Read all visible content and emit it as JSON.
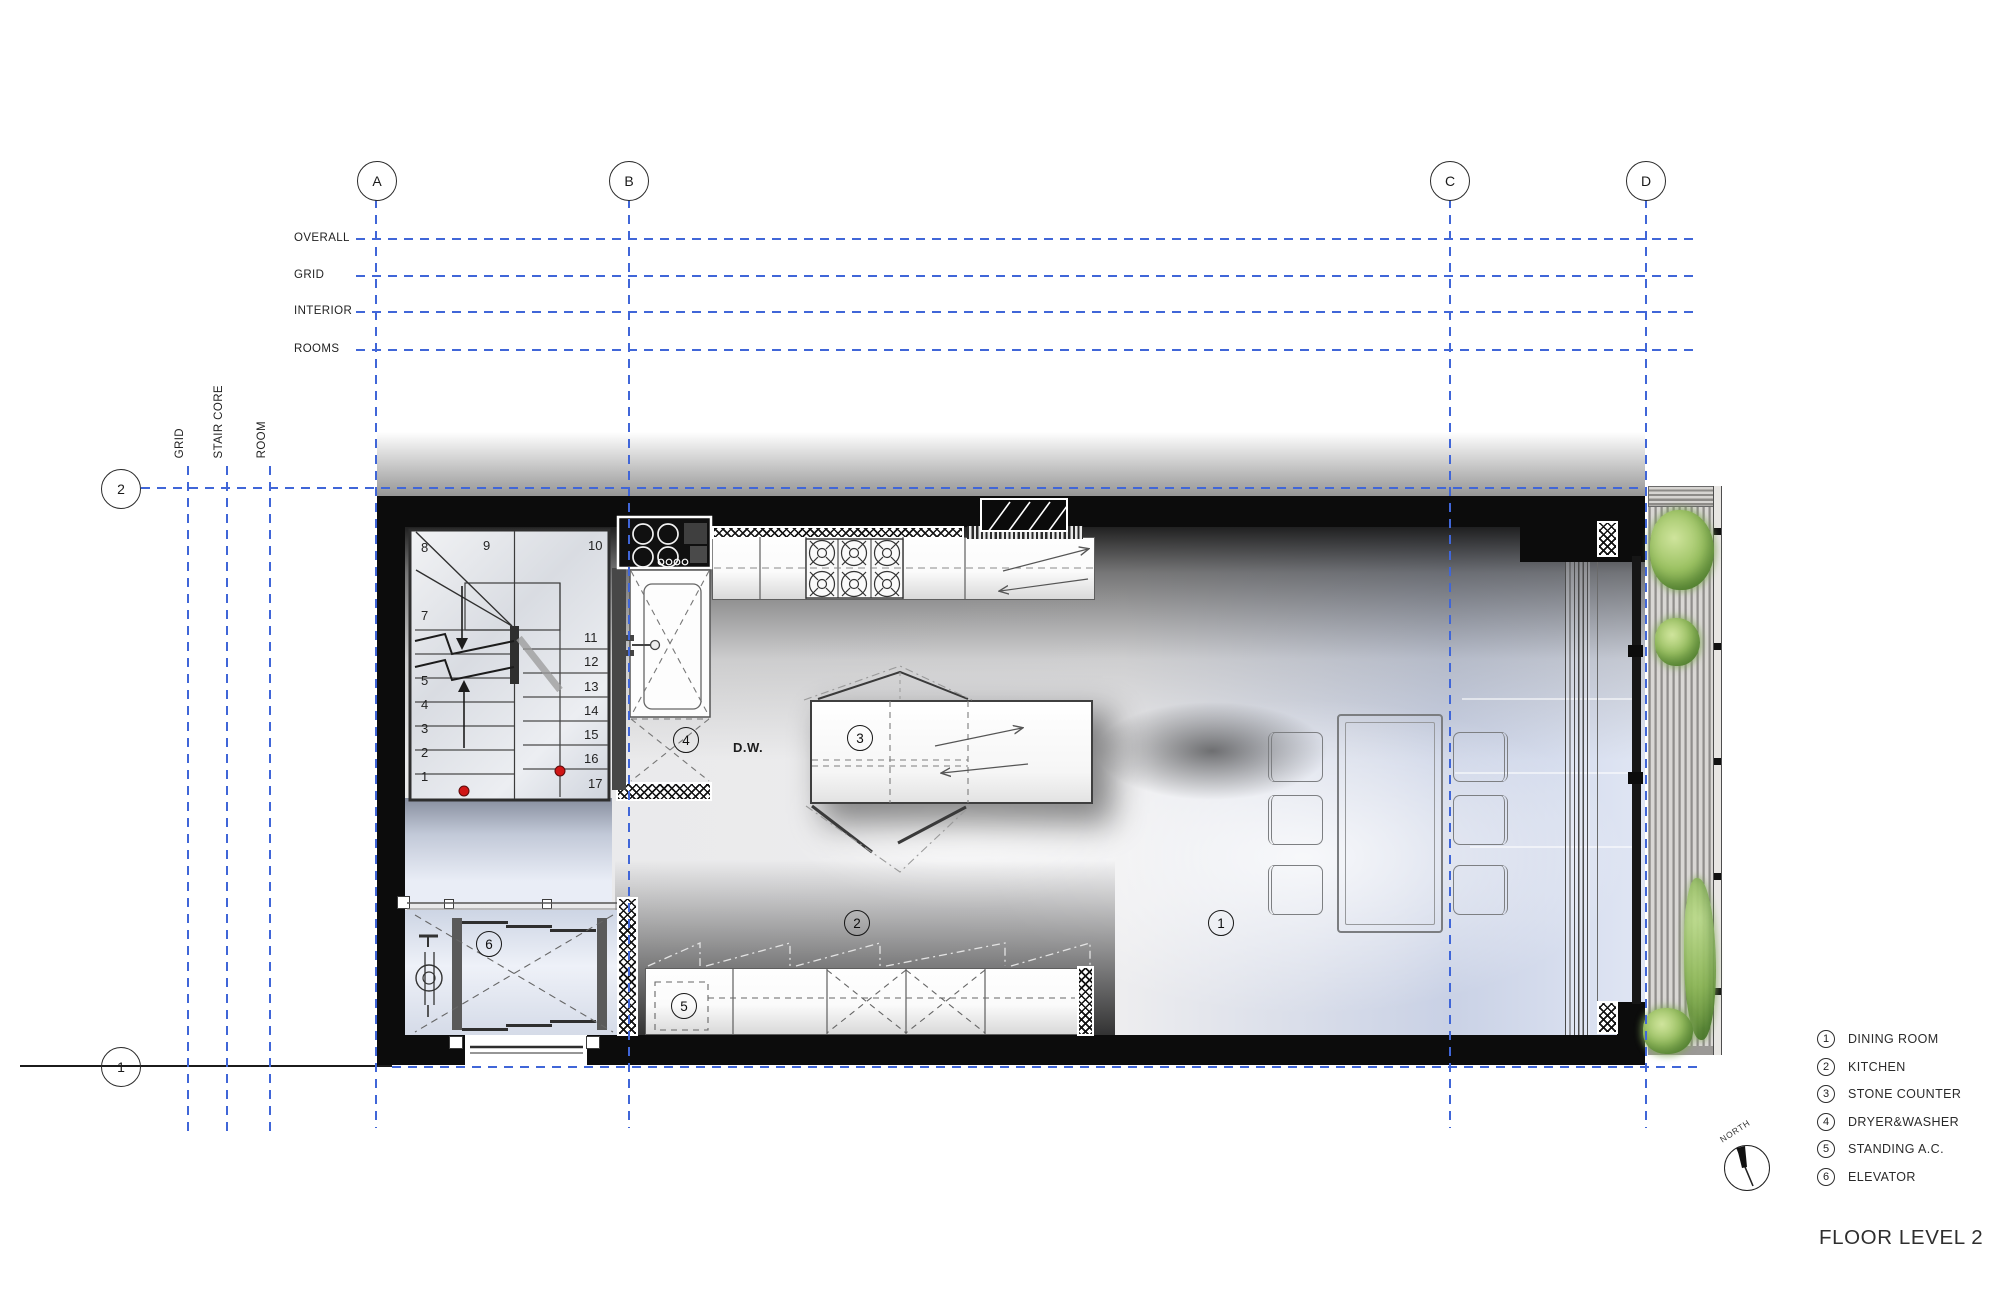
{
  "drawing": {
    "title": "FLOOR LEVEL 2",
    "north_label": "NORTH",
    "dw_label": "D.W."
  },
  "grid": {
    "columns": [
      "A",
      "B",
      "C",
      "D"
    ],
    "rows": [
      "2",
      "1"
    ],
    "top_guides": [
      "OVERALL",
      "GRID",
      "INTERIOR",
      "ROOMS"
    ],
    "left_guides": [
      "GRID",
      "STAIR CORE",
      "ROOM"
    ]
  },
  "stairs": {
    "numbers": [
      "8",
      "9",
      "10",
      "7",
      "5",
      "4",
      "3",
      "2",
      "1",
      "11",
      "12",
      "13",
      "14",
      "15",
      "16",
      "17"
    ]
  },
  "callouts": [
    "1",
    "2",
    "3",
    "4",
    "5",
    "6"
  ],
  "legend": [
    {
      "num": "1",
      "label": "DINING ROOM"
    },
    {
      "num": "2",
      "label": "KITCHEN"
    },
    {
      "num": "3",
      "label": "STONE COUNTER"
    },
    {
      "num": "4",
      "label": "DRYER&WASHER"
    },
    {
      "num": "5",
      "label": "STANDING A.C."
    },
    {
      "num": "6",
      "label": "ELEVATOR"
    }
  ]
}
